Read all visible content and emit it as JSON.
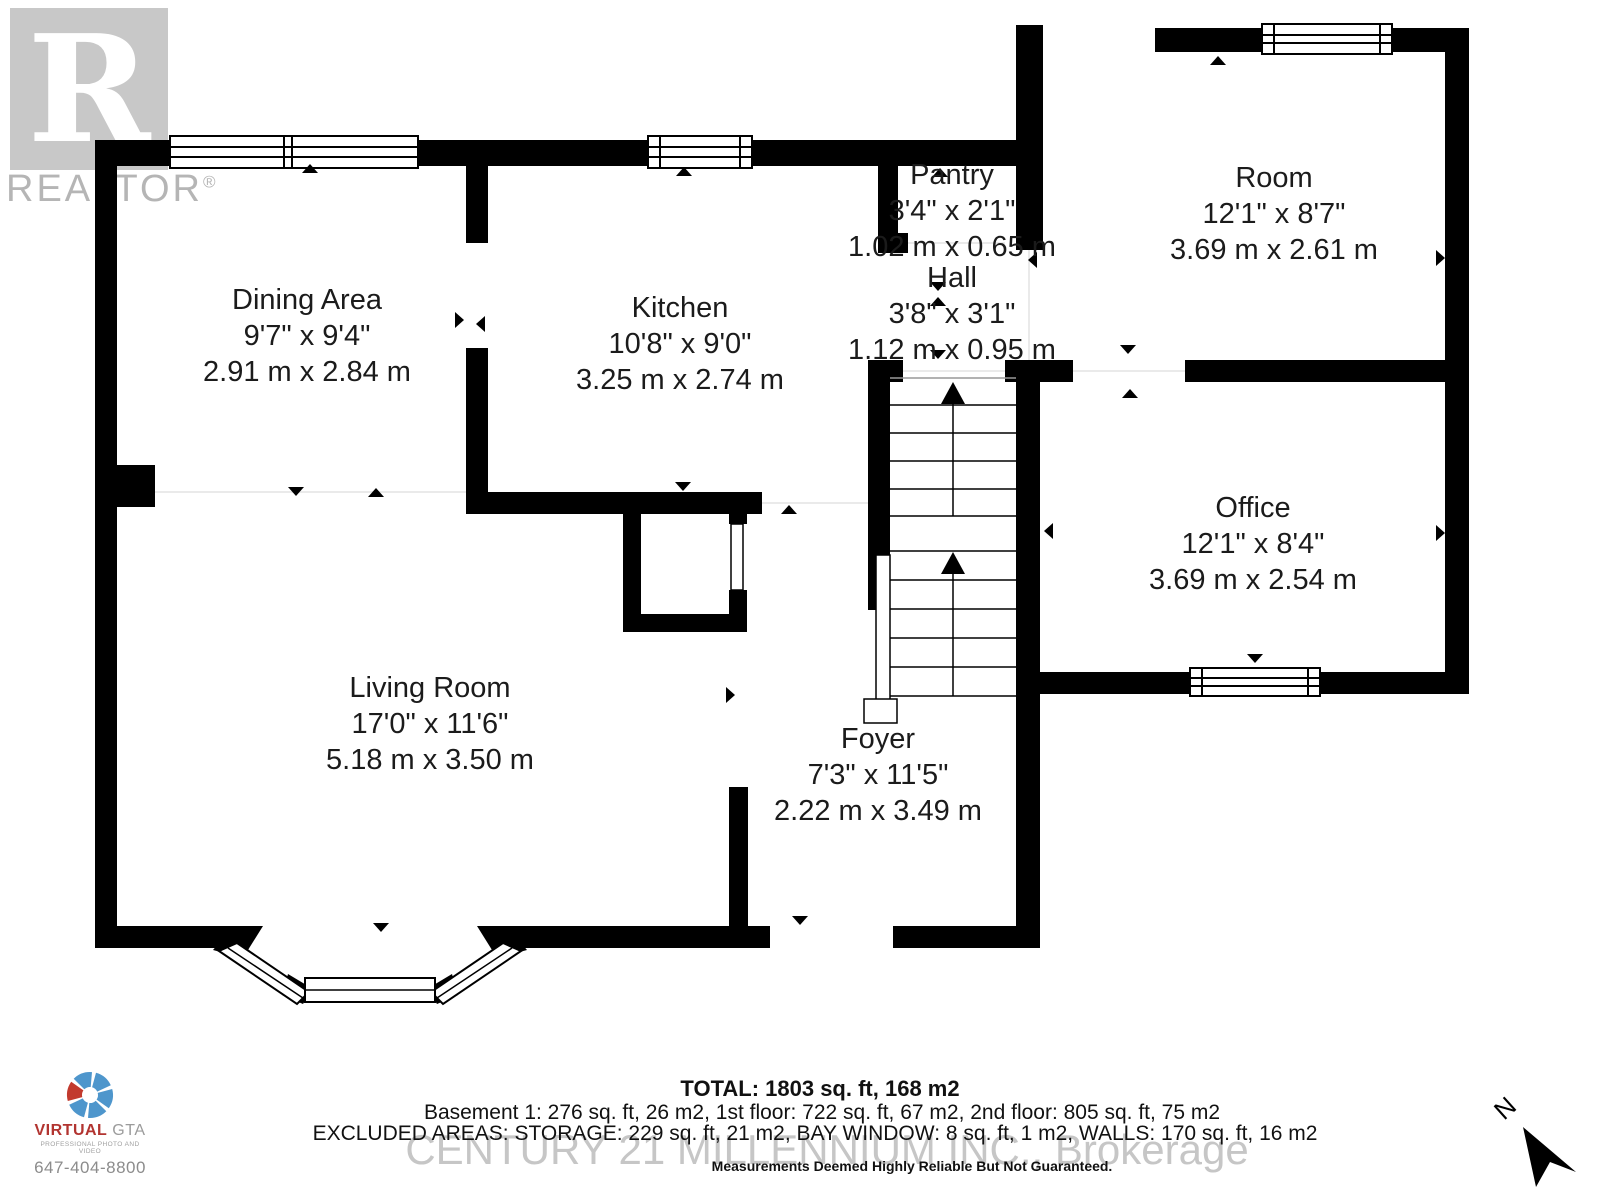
{
  "branding": {
    "realtor_letter": "R",
    "realtor_text": "REALTOR",
    "realtor_registered": "®",
    "century_watermark": "CENTURY 21 MILLENNIUM INC., Brokerage",
    "virtual": {
      "name": "VIRTUAL",
      "suffix": "GTA",
      "tagline": "PROFESSIONAL PHOTO AND VIDEO",
      "phone": "647-404-8800"
    }
  },
  "compass": {
    "label": "N"
  },
  "rooms": [
    {
      "name": "Dining Area",
      "imperial": "9'7\" x 9'4\"",
      "metric": "2.91 m x 2.84 m"
    },
    {
      "name": "Kitchen",
      "imperial": "10'8\" x 9'0\"",
      "metric": "3.25 m x 2.74 m"
    },
    {
      "name": "Pantry",
      "imperial": "3'4\" x 2'1\"",
      "metric": "1.02 m x 0.65 m"
    },
    {
      "name": "Hall",
      "imperial": "3'8\" x 3'1\"",
      "metric": "1.12 m x 0.95 m"
    },
    {
      "name": "Room",
      "imperial": "12'1\" x 8'7\"",
      "metric": "3.69 m x 2.61 m"
    },
    {
      "name": "Office",
      "imperial": "12'1\" x 8'4\"",
      "metric": "3.69 m x 2.54 m"
    },
    {
      "name": "Living Room",
      "imperial": "17'0\" x 11'6\"",
      "metric": "5.18 m x 3.50 m"
    },
    {
      "name": "Foyer",
      "imperial": "7'3\" x 11'5\"",
      "metric": "2.22 m x 3.49 m"
    }
  ],
  "footer": {
    "total": "TOTAL: 1803 sq. ft, 168 m2",
    "floors": "Basement 1: 276 sq. ft, 26 m2, 1st floor: 722 sq. ft, 67 m2, 2nd floor: 805 sq. ft, 75 m2",
    "excluded": "EXCLUDED AREAS: STORAGE: 229 sq. ft, 21 m2, BAY WINDOW: 8 sq. ft, 1 m2, WALLS: 170 sq. ft, 16 m2",
    "disclaimer": "Measurements Deemed Highly Reliable But Not Guaranteed."
  },
  "colors": {
    "wall": "#000000",
    "watermark_gray": "#c6c6c6",
    "logo_blue": "#4e96cc",
    "logo_red": "#c23a2e"
  }
}
